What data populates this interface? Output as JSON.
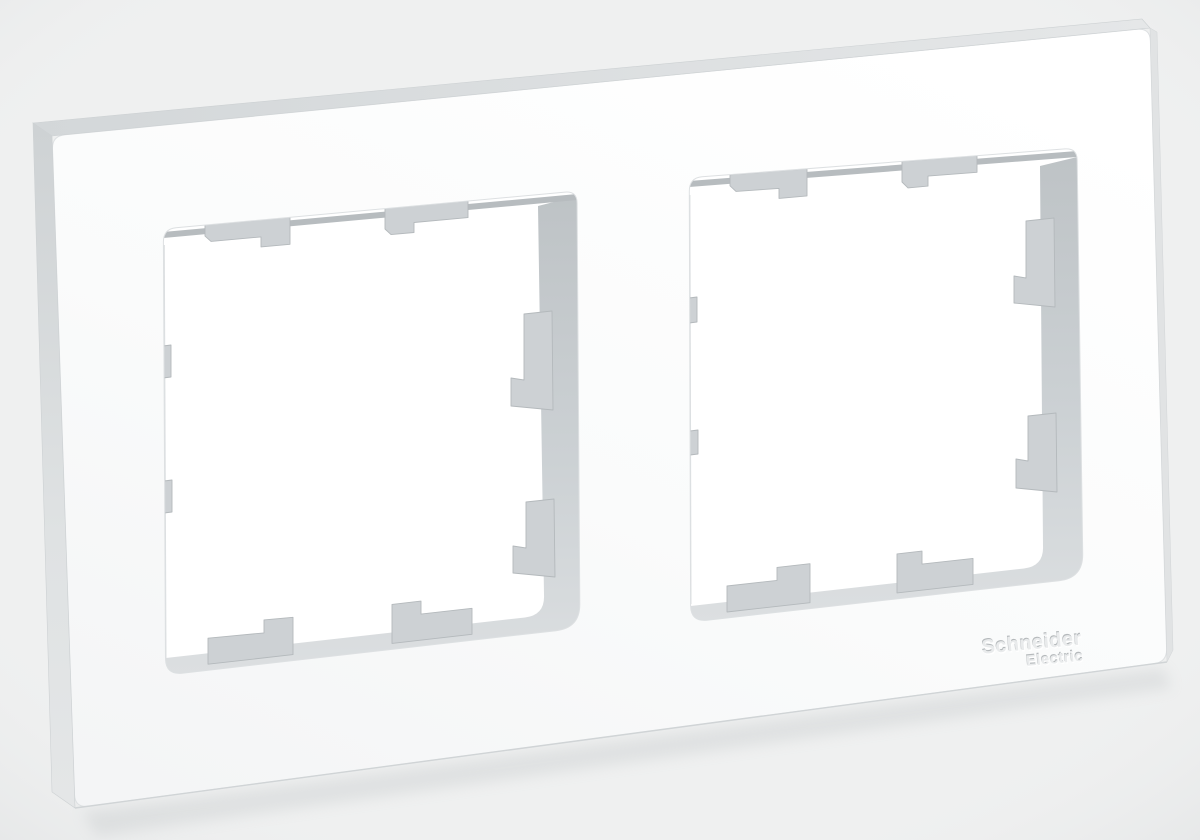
{
  "scene": {
    "background_color": "#eff0f0",
    "colors": {
      "frame_face": "#fbfcfc",
      "frame_top_side": "#d9dcde",
      "frame_left_side": "#d4d8da",
      "opening_wall": "#c8cdd0",
      "latch_tab": "#cdd1d4",
      "latch_tab_edge": "#b4b9bc",
      "logo_text": "#e9ebec"
    },
    "logo": {
      "line1": "Schneider",
      "line2": "Electric"
    }
  }
}
